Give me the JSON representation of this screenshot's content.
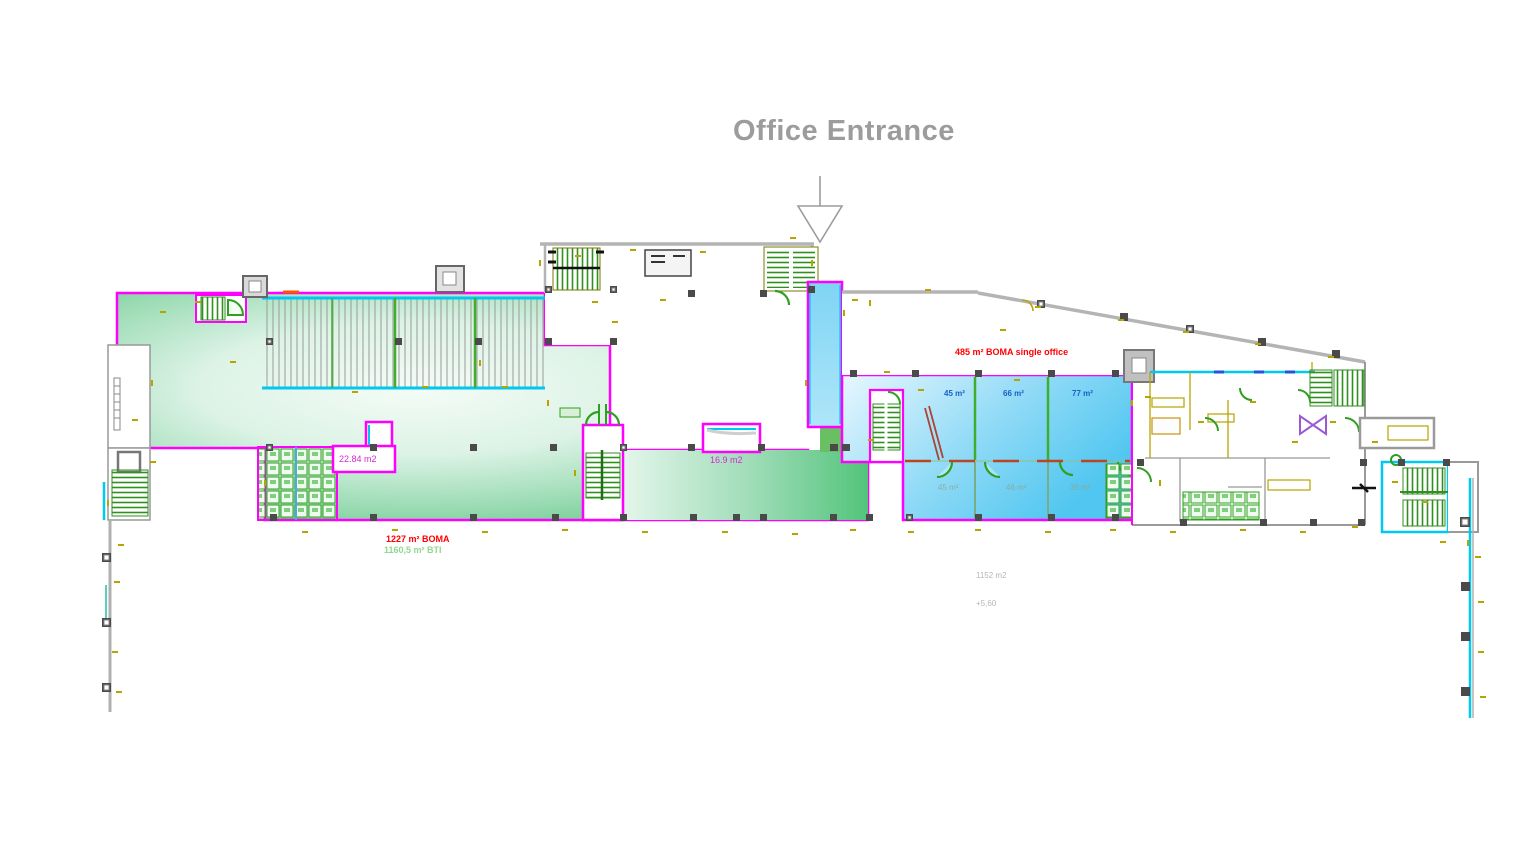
{
  "title": "Office Entrance",
  "plan": {
    "left_zone": {
      "boma_label": "1227 m² BOMA",
      "bti_label": "1160,5 m² BTI",
      "small_room_label": "22.84 m2",
      "core_room_label": "16.9 m2"
    },
    "right_zone": {
      "boma_label": "485 m² BOMA single office",
      "offices_top": [
        "45 m²",
        "66 m²",
        "77 m²"
      ],
      "offices_bottom": [
        "45 m²",
        "46 m²",
        "35 m²"
      ],
      "area_note": "1152 m2",
      "level_note": "+5,60"
    }
  },
  "colors": {
    "lease_outline": "#ff00ff",
    "wall_cyan": "#00c8ee",
    "stair_green": "#2f8f1f",
    "annotation_olive": "#b8a400",
    "area_green": "#5ec683",
    "area_blue": "#55c8f1",
    "boma_red": "#ff0000",
    "bti_green": "#8fd98f",
    "office_label_blue": "#1a5fc8",
    "wall_gray": "#b0b0b0",
    "title_gray": "#9c9c9c"
  }
}
